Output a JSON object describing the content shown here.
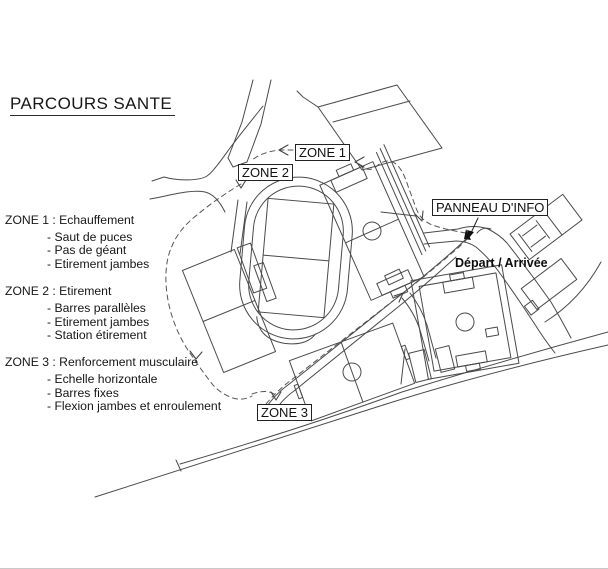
{
  "title": "PARCOURS SANTE",
  "legend": {
    "sections": [
      {
        "title": "ZONE 1 : Echauffement",
        "items": [
          "- Saut de puces",
          "- Pas de géant",
          "- Etirement jambes"
        ]
      },
      {
        "title": "ZONE 2 : Etirement",
        "items": [
          "- Barres parallèles",
          "- Etirement jambes",
          "- Station étirement"
        ]
      },
      {
        "title": "ZONE 3 : Renforcement musculaire",
        "items": [
          "- Echelle horizontale",
          "- Barres fixes",
          "- Flexion jambes et enroulement"
        ]
      }
    ]
  },
  "map_labels": {
    "zone1": "ZONE 1",
    "zone2": "ZONE 2",
    "zone3": "ZONE 3",
    "panneau": "PANNEAU D'INFO",
    "depart": "Départ / Arrivée"
  },
  "icons": {
    "trail_arrow": "v-arrowhead",
    "depart_marker": "filled-triangle",
    "panneau_pointer": "filled-arrow"
  },
  "colors": {
    "background": "#ffffff",
    "line": "#464646",
    "trail": "#555555",
    "label_border": "#222222",
    "text": "#111111"
  }
}
